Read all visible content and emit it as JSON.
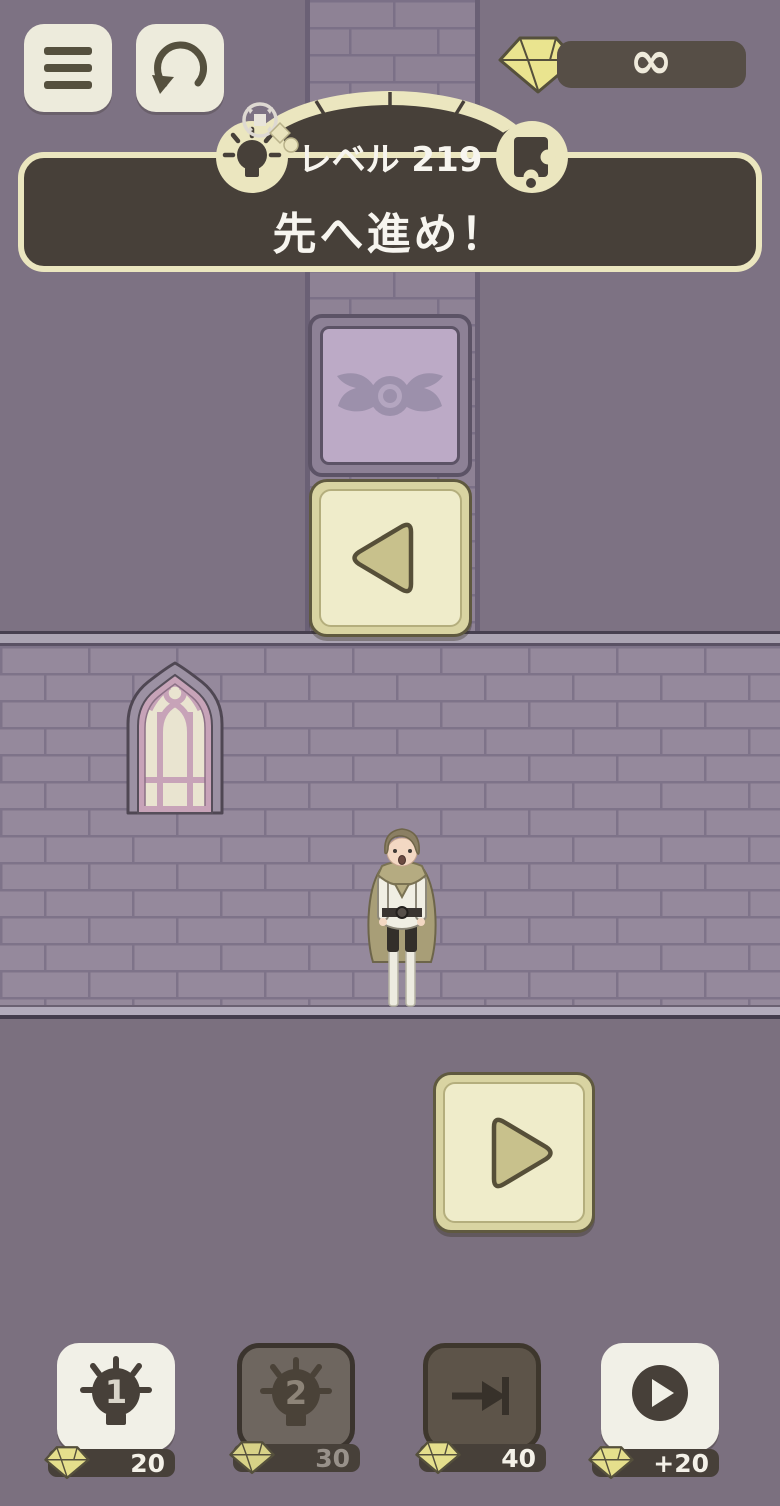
{
  "colors": {
    "background_purple": "#7d7283",
    "brick_wall": "#95899c",
    "cream": "#ebe6bf",
    "panel_dark": "#474039",
    "tile_purple": "#bcaac6",
    "window_pink": "#c7a3b8",
    "gem_yellow": "#eae48f"
  },
  "topbar": {
    "menu_icon": "hamburger-menu",
    "restart_icon": "restart-arrow",
    "gem_counter": {
      "gem_icon": "diamond-gem",
      "value": "∞"
    }
  },
  "banner": {
    "level_label": "レベル 219",
    "message": "先へ進め！",
    "left_badge_icon": "lightbulb",
    "right_badge_icon": "puzzle-piece",
    "ornament_icon": "sparkle-compass"
  },
  "board": {
    "emblem_tile_icon": "winged-circle-emblem",
    "back_tile_icon": "left-triangle",
    "play_tile_icon": "right-triangle"
  },
  "shop": {
    "buttons": [
      {
        "name": "hint-1",
        "icon": "bulb-1-icon",
        "bulb_number": "1",
        "cost": "20",
        "enabled": true
      },
      {
        "name": "hint-2",
        "icon": "bulb-2-icon",
        "bulb_number": "2",
        "cost": "30",
        "enabled": false
      },
      {
        "name": "skip-level",
        "icon": "skip-to-end-icon",
        "cost": "40",
        "enabled": false
      },
      {
        "name": "earn-gems",
        "icon": "play-video-icon",
        "cost": "+20",
        "enabled": true
      }
    ]
  }
}
